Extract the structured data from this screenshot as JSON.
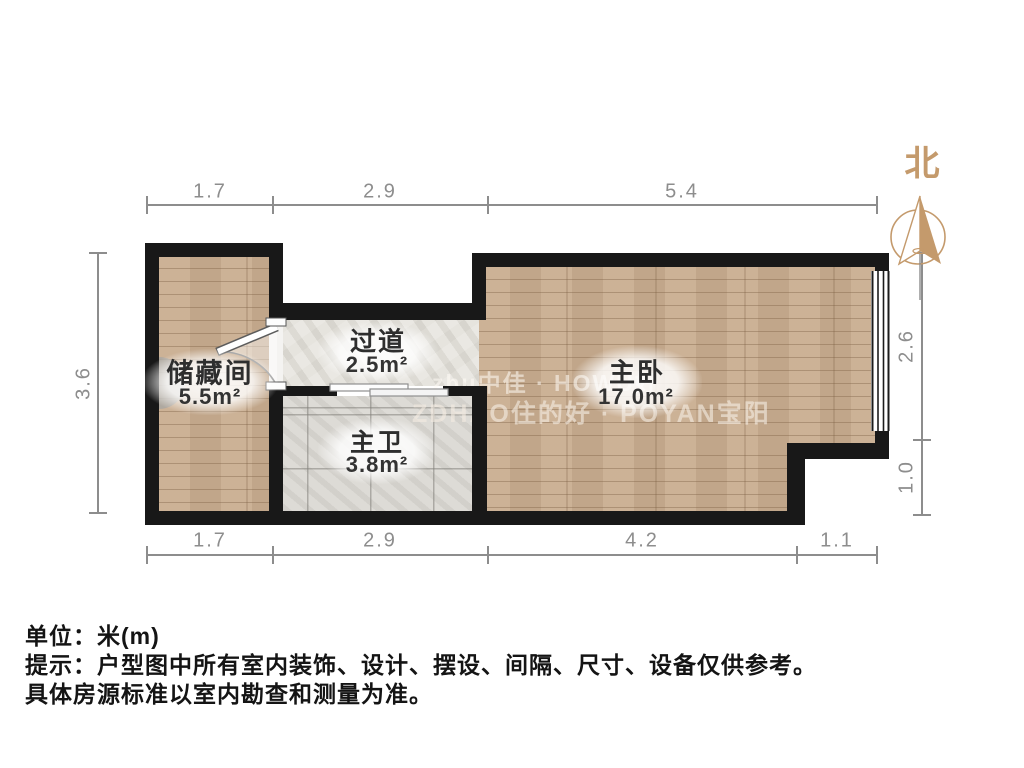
{
  "compass": {
    "label": "北"
  },
  "rooms": {
    "storage": {
      "name": "储藏间",
      "area": "5.5m²"
    },
    "hallway": {
      "name": "过道",
      "area": "2.5m²"
    },
    "bathroom": {
      "name": "主卫",
      "area": "3.8m²"
    },
    "bedroom": {
      "name": "主卧",
      "area": "17.0m²"
    }
  },
  "dimensions": {
    "top": [
      "1.7",
      "2.9",
      "5.4"
    ],
    "bottom": [
      "1.7",
      "2.9",
      "4.2",
      "1.1"
    ],
    "left": [
      "3.6"
    ],
    "right": [
      "2.6",
      "1.0"
    ]
  },
  "watermarks": [
    "zhu中佳 · HOWU好",
    "ZDHAO住的好 · POYAN宝阳"
  ],
  "footnotes": {
    "unit": "单位：米(m)",
    "tip_line1": "提示：户型图中所有室内装饰、设计、摆设、间隔、尺寸、设备仅供参考。",
    "tip_line2": "具体房源标准以室内勘查和测量为准。"
  },
  "colors": {
    "wall": "#181818",
    "wood_floor": "#c9ad90",
    "tile_floor": "#d8d6d1",
    "marble_floor": "#e4e2dd",
    "dimension_gray": "#8d8d8d",
    "compass_tan": "#c49a6c",
    "label_text": "#2e2e2e"
  }
}
